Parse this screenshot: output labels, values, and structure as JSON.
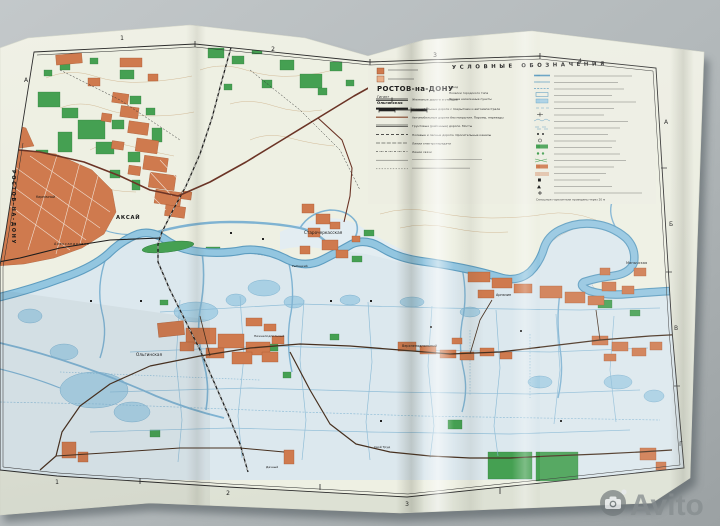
{
  "watermark": {
    "brand": "Avito",
    "icon": "camera-icon",
    "color": "#878d90"
  },
  "map_sheet": {
    "title_block": {
      "title": "РОСТОВ-на-ДОНУ",
      "sub_items": [
        "Гигант",
        "Ольгинская"
      ],
      "settlement_classes": [
        "Город",
        "Поселки городского типа",
        "Прочие населенные пункты"
      ]
    },
    "legend": {
      "header": "УСЛОВНЫЕ ОБОЗНАЧЕНИЯ",
      "left_items": [
        "Железные дороги и станции",
        "Автомобильные дороги с покрытием и автомагистрали",
        "Автомобильные дороги без покрытия. Паромы, переезды",
        "Грунтовые (районные) дороги. Мосты",
        "Полевые и лесные дороги. Оросительные каналы",
        "Линии электропередачи",
        "Линии связи"
      ],
      "footnote": "Сплошные горизонтали проведены через 20 м"
    },
    "grid_labels": {
      "top": [
        "1",
        "2",
        "3",
        "4"
      ],
      "bottom": [
        "1",
        "2",
        "3"
      ],
      "right": [
        "А",
        "Б",
        "В",
        "Г"
      ],
      "left": [
        "А"
      ]
    },
    "place_labels": {
      "city_vertical": "РОСТОВ-НА-ДОНУ",
      "towns": [
        {
          "name": "Кирпичный"
        },
        {
          "name": "Александровка"
        },
        {
          "name": "АКСАЙ"
        },
        {
          "name": "Старочеркасская"
        },
        {
          "name": "Рыбацкий"
        },
        {
          "name": "Манычская"
        },
        {
          "name": "Арпачин"
        },
        {
          "name": "Ольгинская"
        },
        {
          "name": "Нижнеподпольный"
        },
        {
          "name": "Верхнеподпольный"
        },
        {
          "name": "Свой Труд"
        },
        {
          "name": "Дачный"
        }
      ]
    },
    "colors": {
      "paper": "#eaecdf",
      "water": "#8dc0dd",
      "water_deep": "#5e9dc0",
      "forest": "#45a052",
      "settlement": "#cf7a4e",
      "road": "#6b3426",
      "background": "#b4babc"
    }
  }
}
